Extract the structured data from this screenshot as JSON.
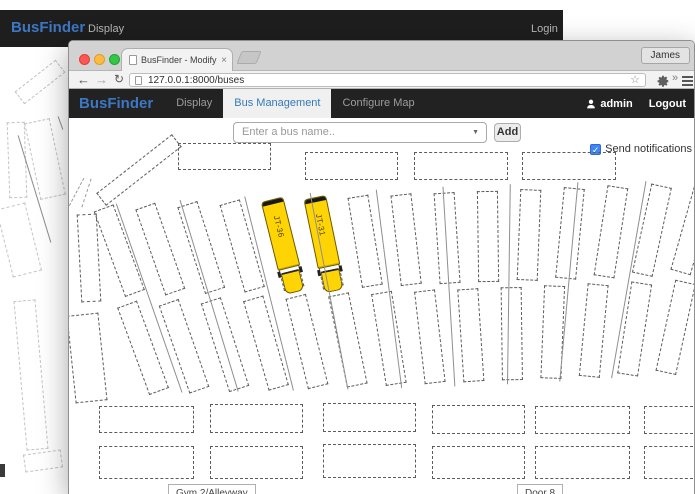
{
  "background_window": {
    "brand": "BusFinder",
    "display_link": "Display",
    "login_link": "Login"
  },
  "browser": {
    "tab_title": "BusFinder - Modify Buses",
    "profile_button": "James",
    "url": "127.0.0.1:8000/buses"
  },
  "app": {
    "brand": "BusFinder",
    "nav_display": "Display",
    "nav_bus_management": "Bus Management",
    "nav_configure_map": "Configure Map",
    "user": "admin",
    "logout": "Logout"
  },
  "controls": {
    "bus_select_placeholder": "Enter a bus name..",
    "add_button": "Add",
    "notifications_label": "Send notifications",
    "notifications_checked": true
  },
  "map": {
    "buses": [
      {
        "id": "JT-36",
        "col": 4
      },
      {
        "id": "JT-31",
        "col": 5
      }
    ],
    "labels": {
      "gym": "Gym 2/Alleyway",
      "door": "Door 8"
    },
    "bus_color": "#FFD404"
  },
  "icons": {
    "back": "←",
    "forward": "→",
    "reload": "↻",
    "star": "☆",
    "overflow": "»",
    "tab_close": "×",
    "select_caret": "▼",
    "checkbox_check": "✓"
  },
  "colors": {
    "accent_blue": "#337AB7",
    "navbar_bg": "#222222",
    "bus_yellow": "#FFD404",
    "checkbox_blue": "#4285F4"
  }
}
